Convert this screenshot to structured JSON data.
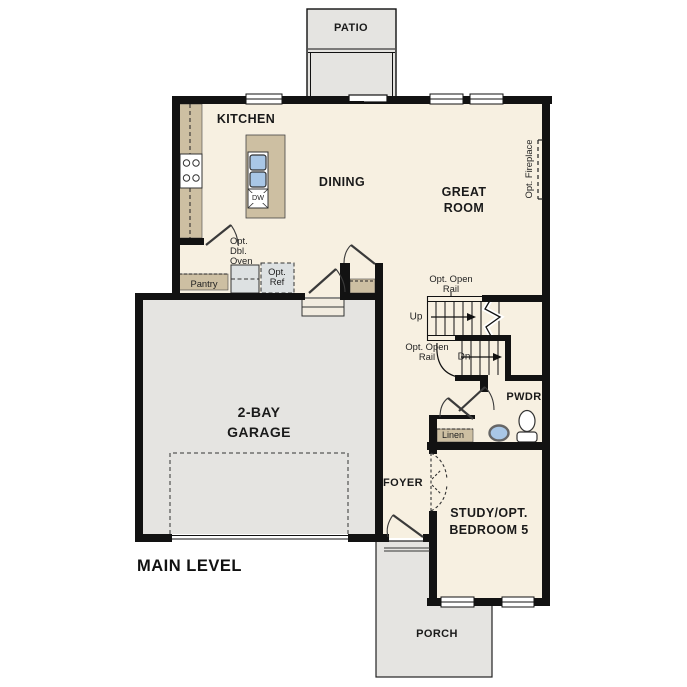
{
  "title": "MAIN LEVEL",
  "rooms": {
    "patio": "PATIO",
    "kitchen": "KITCHEN",
    "dining": "DINING",
    "great_room": "GREAT\nROOM",
    "garage": "2-BAY\nGARAGE",
    "foyer": "FOYER",
    "pwdr": "PWDR",
    "study": "STUDY/OPT.\nBEDROOM 5",
    "porch": "PORCH"
  },
  "annotations": {
    "opt_fireplace": "Opt. Fireplace",
    "opt_dbl_oven": "Opt.\nDbl.\nOven",
    "pantry": "Pantry",
    "opt_ref": "Opt.\nRef",
    "opt_open_rail_upper": "Opt. Open\nRail",
    "up": "Up",
    "opt_open_rail_lower": "Opt. Open\nRail",
    "dn": "Dn",
    "linen": "Linen",
    "dw": "DW"
  },
  "colors": {
    "floor": "#f7f0e1",
    "exterior": "#e5e4e1",
    "counter": "#cdbfa2",
    "wall": "#121212",
    "sink_blue": "#a9c7e6",
    "cabinet": "#dde1e2",
    "text": "#1a1a1a"
  }
}
